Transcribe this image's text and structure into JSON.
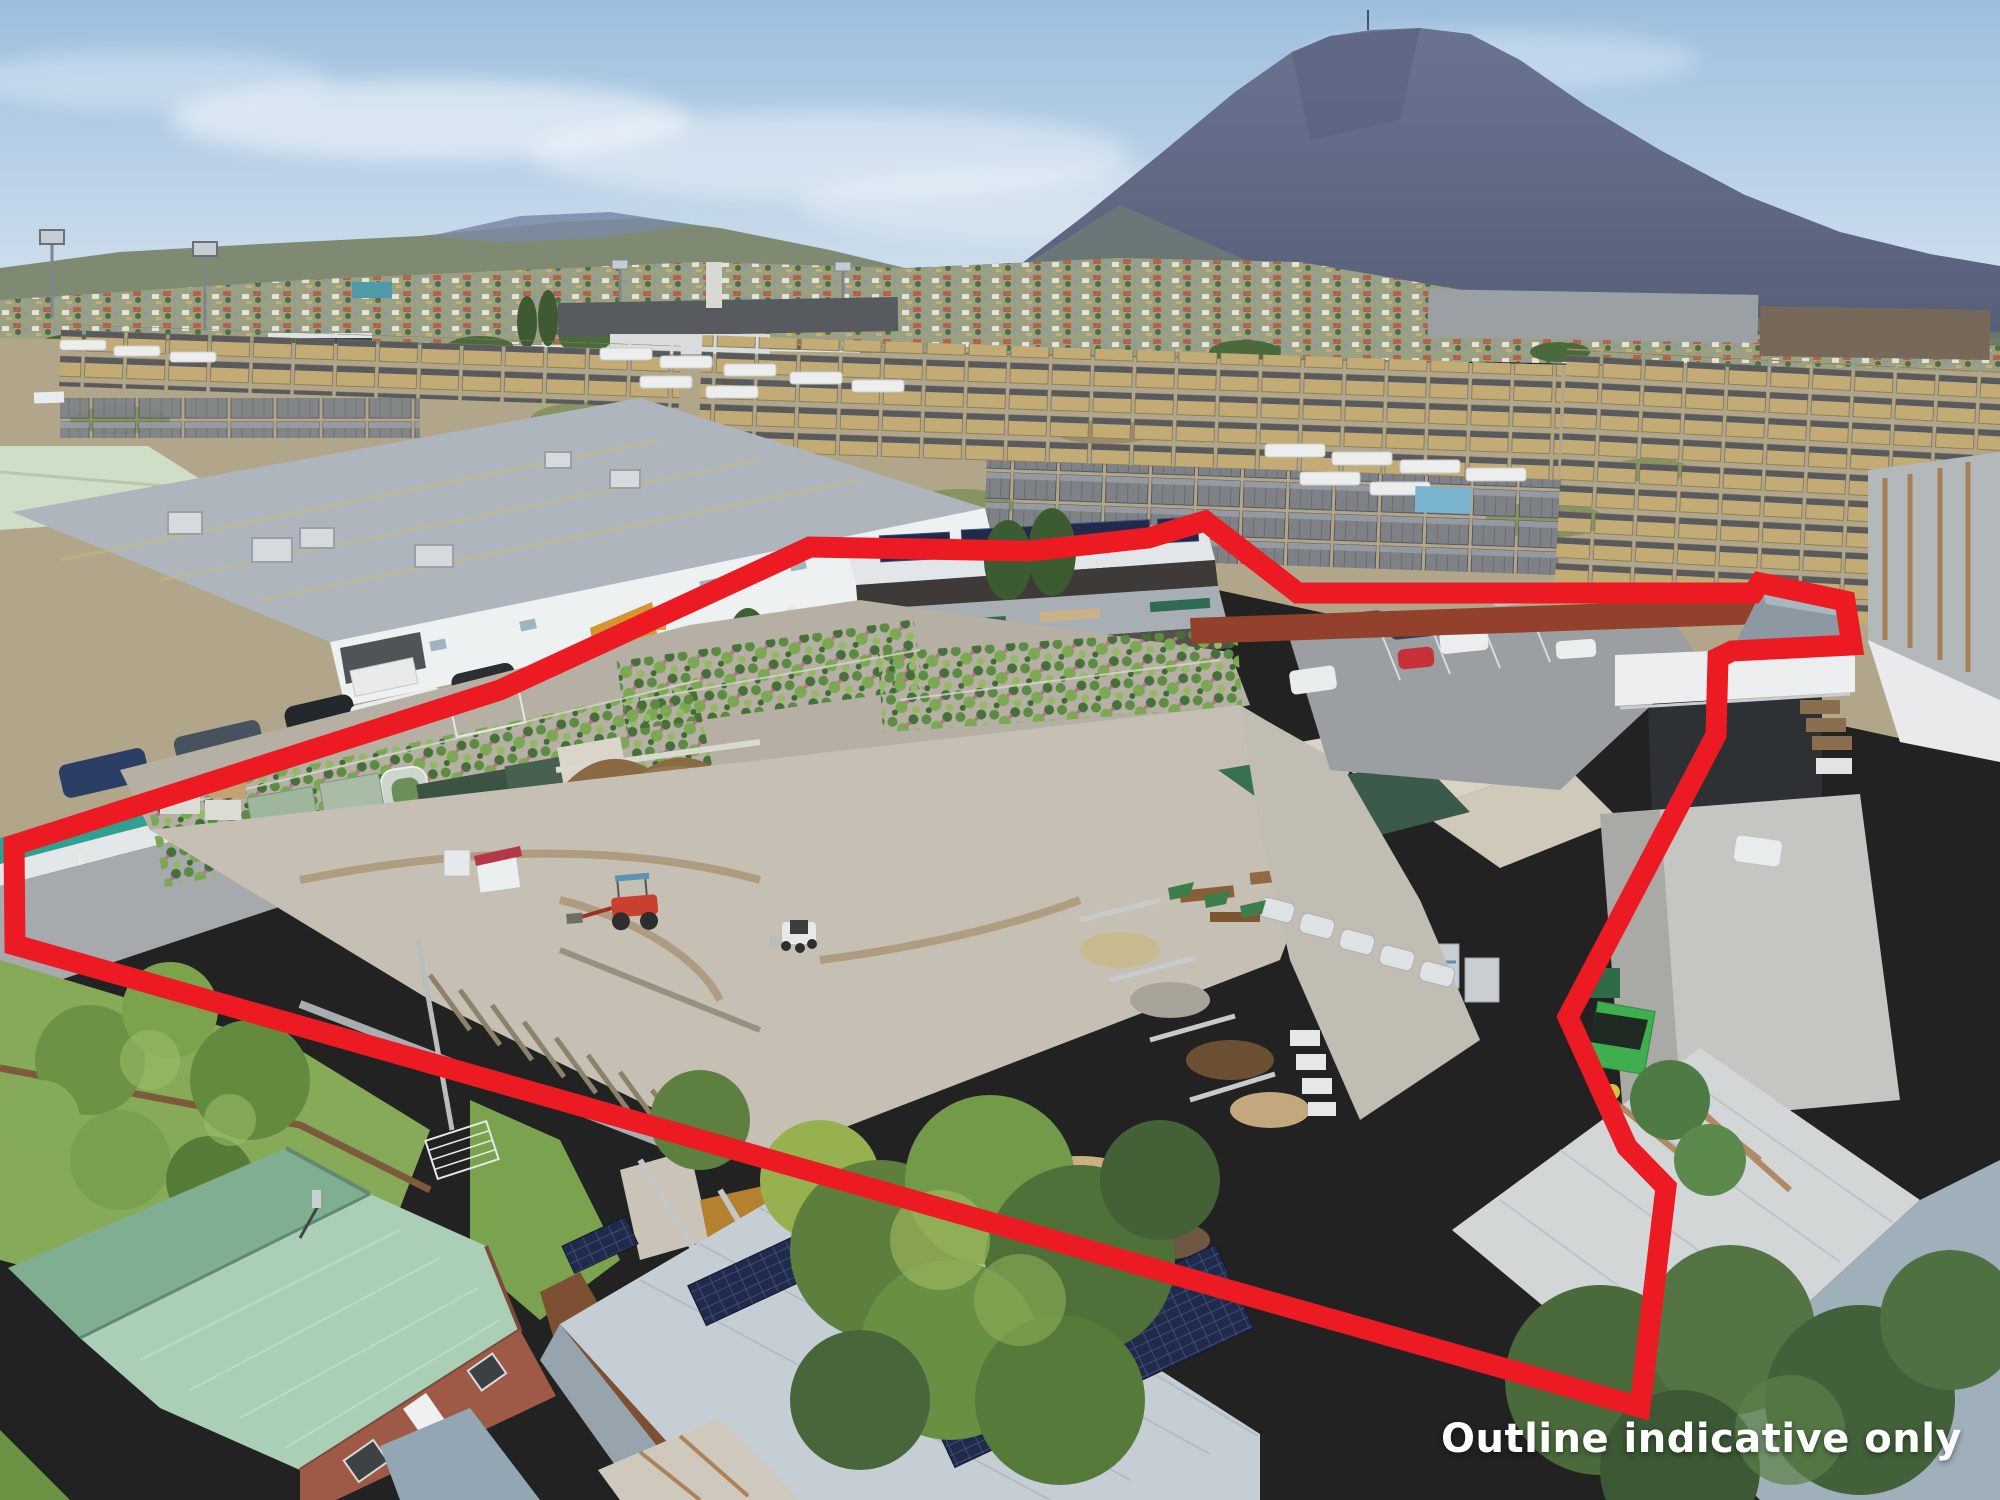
{
  "annotation": {
    "disclaimer": "Outline indicative only"
  },
  "colors": {
    "outline-red": "#ec1b23",
    "disclaimer-text": "#ffffff",
    "sky-top": "#9cbede",
    "sky-horizon": "#dce7f1",
    "mountain-top": "#6a7390",
    "mountain-base": "#565e78",
    "awning-teal": "#2fa192",
    "solar-panel": "#202a4a",
    "house-roof-mint": "#abceb6",
    "container-rust": "#a04a2e",
    "lawn": "#86aa57"
  },
  "scene": {
    "type": "aerial-drone-photograph",
    "subject": "garden-centre-and-landscape-supplies-yard",
    "overlay": "red-property-boundary-outline"
  }
}
